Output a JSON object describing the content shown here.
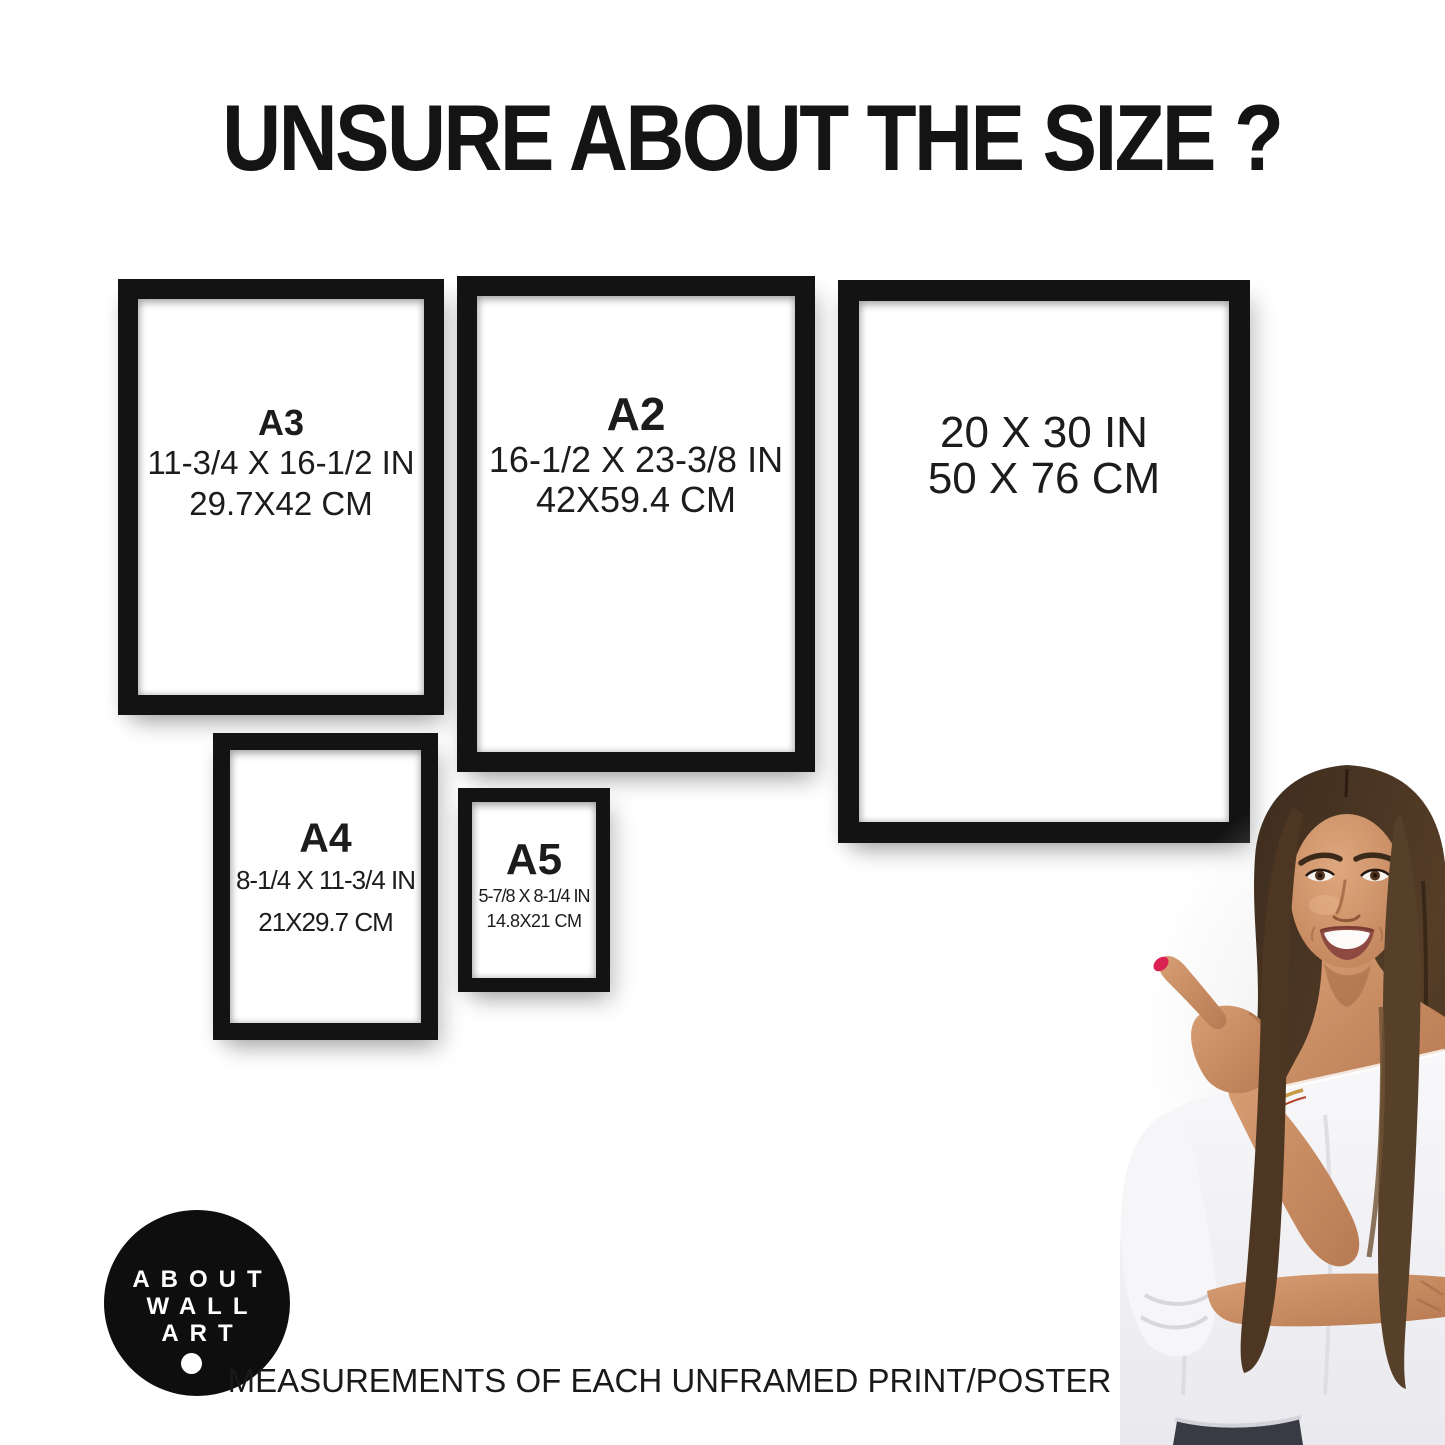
{
  "title": "UNSURE ABOUT THE SIZE ?",
  "frames": [
    {
      "name": "A3",
      "label": "A3",
      "inches": "11-3/4 X 16-1/2 IN",
      "cm": "29.7X42 CM"
    },
    {
      "name": "A2",
      "label": "A2",
      "inches": "16-1/2 X 23-3/8 IN",
      "cm": "42X59.4 CM"
    },
    {
      "name": "20x30",
      "label": "",
      "inches": "20 X 30 IN",
      "cm": "50 X 76 CM"
    },
    {
      "name": "A4",
      "label": "A4",
      "inches": "8-1/4 X 11-3/4 IN",
      "cm": "21X29.7 CM"
    },
    {
      "name": "A5",
      "label": "A5",
      "inches": "5-7/8 X 8-1/4 IN",
      "cm": "14.8X21 CM"
    }
  ],
  "logo": {
    "line1": "ABOUT",
    "line2": "WALL",
    "line3": "ART"
  },
  "footer": "MEASUREMENTS OF EACH UNFRAMED PRINT/POSTER",
  "colors": {
    "frame_black": "#131313",
    "text": "#1c1c1c",
    "logo_bg": "#0e0e0e",
    "logo_text": "#ffffff",
    "nail_red": "#da2253",
    "hair_brown": "#4a3423",
    "skin": "#c78e66",
    "blouse_white": "#f2f2f4",
    "jeans": "#3a3d45"
  }
}
